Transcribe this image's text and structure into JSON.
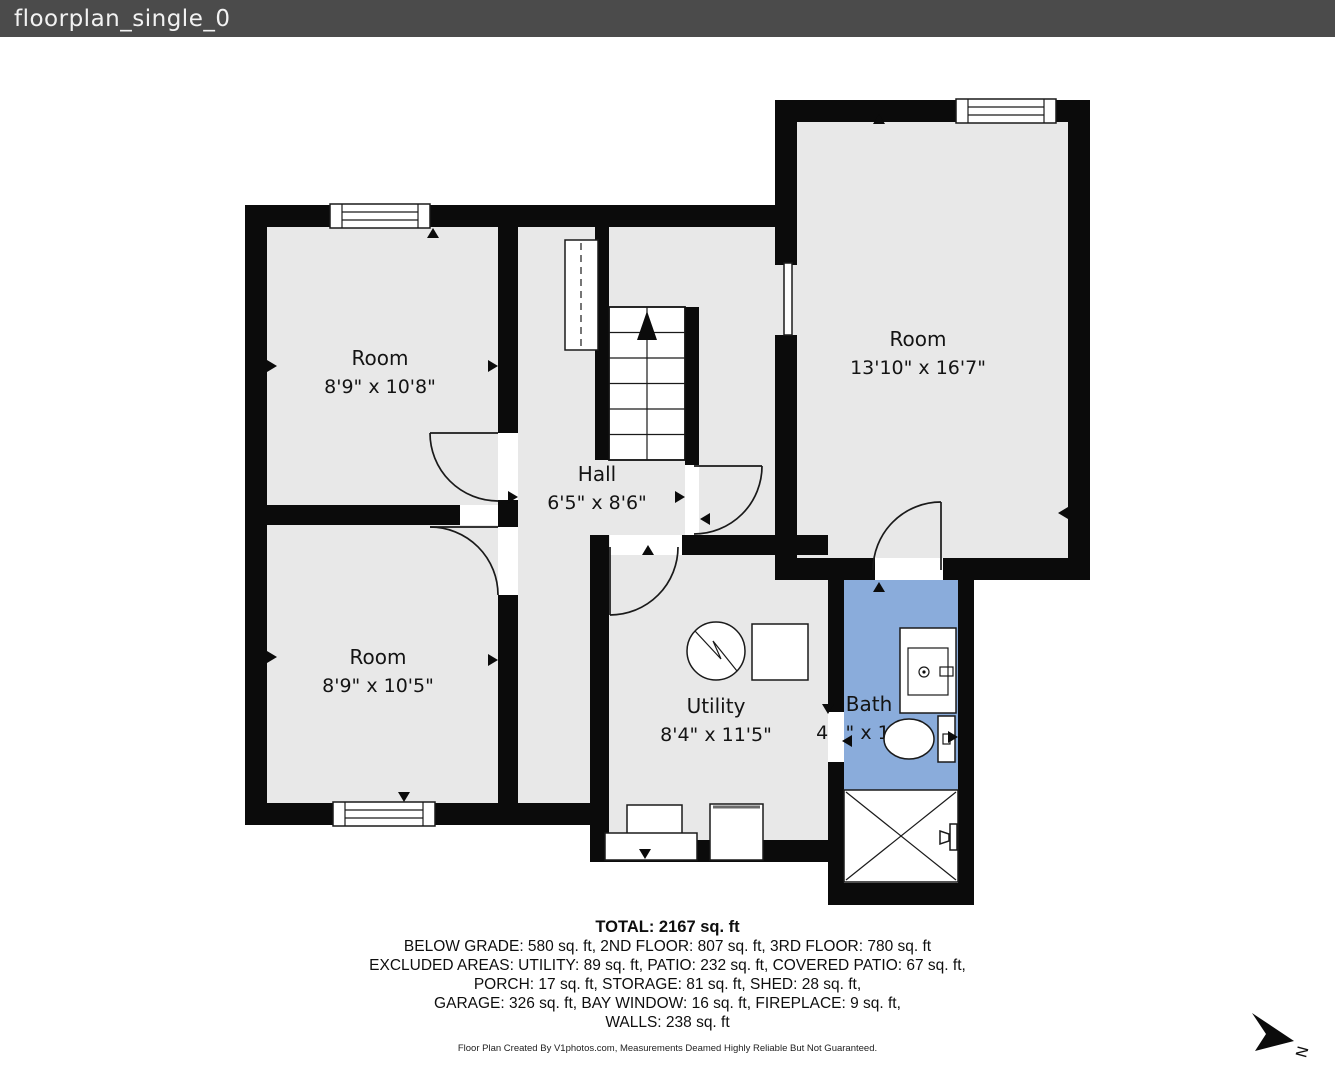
{
  "header": {
    "title": "floorplan_single_0"
  },
  "rooms": [
    {
      "name": "Room",
      "dims": "8'9\" x 10'8\""
    },
    {
      "name": "Room",
      "dims": "13'10\" x 16'7\""
    },
    {
      "name": "Hall",
      "dims": "6'5\" x 8'6\""
    },
    {
      "name": "Room",
      "dims": "8'9\" x 10'5\""
    },
    {
      "name": "Utility",
      "dims": "8'4\" x 11'5\""
    },
    {
      "name": "Bath",
      "dims": "4'1\" x 11'7\""
    }
  ],
  "summary": {
    "total": "TOTAL: 2167 sq. ft",
    "line1": "BELOW GRADE: 580 sq. ft, 2ND FLOOR: 807 sq. ft, 3RD FLOOR: 780 sq. ft",
    "line2": "EXCLUDED AREAS: UTILITY: 89 sq. ft, PATIO: 232 sq. ft, COVERED PATIO: 67 sq. ft,",
    "line3": "PORCH: 17 sq. ft, STORAGE: 81 sq. ft, SHED: 28 sq. ft,",
    "line4": "GARAGE: 326 sq. ft, BAY WINDOW: 16 sq. ft, FIREPLACE: 9 sq. ft,",
    "line5": "WALLS: 238 sq. ft"
  },
  "credit": "Floor Plan Created By V1photos.com, Measurements Deamed Highly Reliable But Not Guaranteed.",
  "compass": {
    "label": "N"
  },
  "colors": {
    "room_floor": "#e8e8e8",
    "bath_floor": "#8aacdb",
    "wall": "#0b0b0b",
    "titlebar_bg": "#4b4b4b"
  }
}
